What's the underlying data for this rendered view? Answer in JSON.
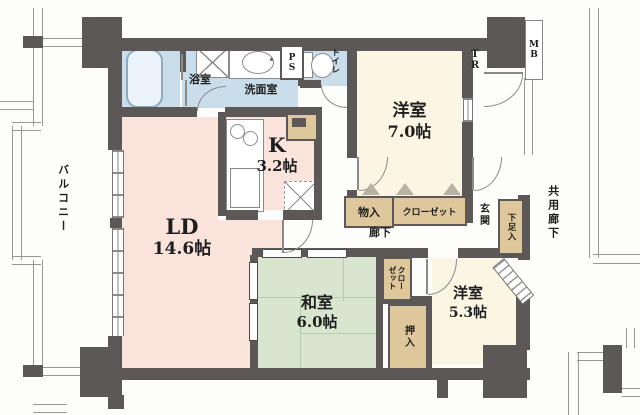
{
  "rooms": {
    "bath": {
      "label": "浴室"
    },
    "washroom": {
      "label": "洗面室"
    },
    "toilet": {
      "label": "トイレ"
    },
    "pipe_space": {
      "label": "PS"
    },
    "trunk_room": {
      "label": "TR"
    },
    "meter_box": {
      "label": "MB"
    },
    "western_7": {
      "name": "洋室",
      "size": "7.0帖"
    },
    "kitchen": {
      "name": "K",
      "size": "3.2帖"
    },
    "living_dining": {
      "name": "LD",
      "size": "14.6帖"
    },
    "japanese_room": {
      "name": "和室",
      "size": "6.0帖"
    },
    "western_5": {
      "name": "洋室",
      "size": "5.3帖"
    },
    "hallway": {
      "label": "廊下"
    },
    "entrance": {
      "label": "玄関"
    },
    "shoe_cabinet": {
      "label": "下足入"
    },
    "storage": {
      "label": "物入"
    },
    "closet_hall": {
      "label": "クローゼット"
    },
    "closet_tatami": {
      "label": "クローゼット"
    },
    "futon_closet": {
      "label": "押入"
    },
    "balcony": {
      "label": "バルコニー"
    },
    "common_corridor": {
      "label": "共用廊下"
    }
  },
  "colors": {
    "wall": "#5d5858",
    "room_pink": "#f9e3da",
    "room_cream": "#fbf6e3",
    "room_green": "#d8e6d0",
    "room_blue": "#c9ddeb",
    "closet_tan": "#dfc79c"
  }
}
